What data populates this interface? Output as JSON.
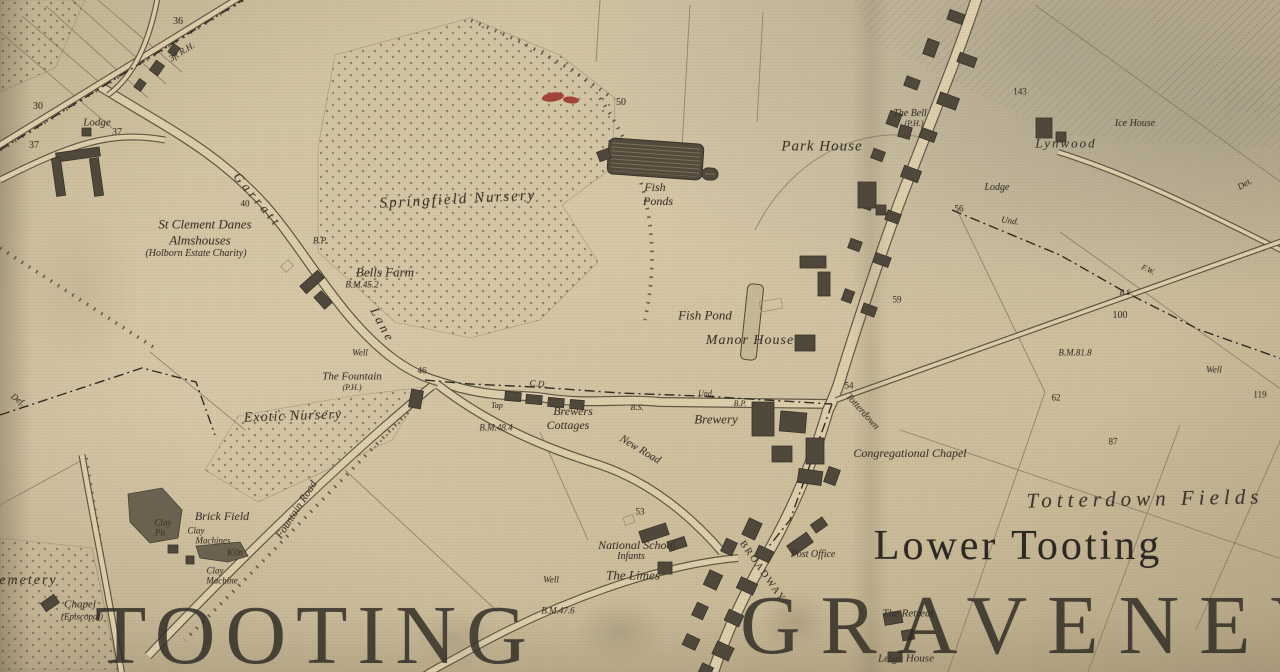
{
  "canvas": {
    "width": 1280,
    "height": 672
  },
  "palette": {
    "paper": "#d4c6a3",
    "road_fill": "#ddcfac",
    "ink": "#3a342a",
    "ink_soft": "#575040",
    "water_dark": "#51493a",
    "pit_fill": "#6a6150",
    "building_dark": "#4e473a",
    "building_light": "#9a917c",
    "red_marker": "#9b2b24",
    "big_text": "#2b2721"
  },
  "labels": [
    {
      "t": "36",
      "x": 178,
      "y": 22,
      "s": 10
    },
    {
      "t": "3ft R.H.",
      "x": 182,
      "y": 52,
      "s": 9,
      "i": 1,
      "r": -32
    },
    {
      "t": "30",
      "x": 38,
      "y": 107,
      "s": 10
    },
    {
      "t": "Lodge",
      "x": 97,
      "y": 123,
      "s": 11,
      "i": 1
    },
    {
      "t": "37",
      "x": 117,
      "y": 133,
      "s": 10
    },
    {
      "t": "37",
      "x": 34,
      "y": 146,
      "s": 10
    },
    {
      "t": "Garratt",
      "x": 258,
      "y": 200,
      "s": 13,
      "i": 1,
      "r": 50,
      "ls": 4
    },
    {
      "t": "Lane",
      "x": 383,
      "y": 325,
      "s": 13,
      "i": 1,
      "r": 62,
      "ls": 3
    },
    {
      "t": "40",
      "x": 245,
      "y": 204,
      "s": 9
    },
    {
      "t": "St Clement Danes",
      "x": 205,
      "y": 224,
      "s": 13,
      "i": 1
    },
    {
      "t": "Almshouses",
      "x": 200,
      "y": 240,
      "s": 13,
      "i": 1
    },
    {
      "t": "(Holborn Estate Charity)",
      "x": 196,
      "y": 254,
      "s": 10,
      "i": 1
    },
    {
      "t": "B.P.",
      "x": 320,
      "y": 241,
      "s": 9,
      "i": 1
    },
    {
      "t": "Springfield Nursery",
      "x": 458,
      "y": 200,
      "s": 15,
      "i": 1,
      "r": -3,
      "ls": 2
    },
    {
      "t": "Bells Farm",
      "x": 385,
      "y": 272,
      "s": 13,
      "i": 1
    },
    {
      "t": "B.M.45.2",
      "x": 362,
      "y": 285,
      "s": 9,
      "i": 1
    },
    {
      "t": "50",
      "x": 621,
      "y": 103,
      "s": 10
    },
    {
      "t": "Fish",
      "x": 655,
      "y": 187,
      "s": 12,
      "i": 1
    },
    {
      "t": "Ponds",
      "x": 658,
      "y": 201,
      "s": 12,
      "i": 1
    },
    {
      "t": "Park House",
      "x": 822,
      "y": 147,
      "s": 15,
      "i": 1,
      "ls": 1
    },
    {
      "t": "The Bell",
      "x": 910,
      "y": 114,
      "s": 10,
      "i": 1
    },
    {
      "t": "(P.H.)",
      "x": 914,
      "y": 124,
      "s": 8,
      "i": 1
    },
    {
      "t": "143",
      "x": 1020,
      "y": 92,
      "s": 9
    },
    {
      "t": "Lynwood",
      "x": 1066,
      "y": 143,
      "s": 13,
      "i": 1,
      "ls": 2
    },
    {
      "t": "Ice House",
      "x": 1135,
      "y": 124,
      "s": 10,
      "i": 1
    },
    {
      "t": "Lodge",
      "x": 997,
      "y": 188,
      "s": 10,
      "i": 1
    },
    {
      "t": "56",
      "x": 959,
      "y": 209,
      "s": 9
    },
    {
      "t": "Und.",
      "x": 1010,
      "y": 221,
      "s": 9,
      "i": 1,
      "r": 8
    },
    {
      "t": "Det.",
      "x": 1245,
      "y": 184,
      "s": 9,
      "i": 1,
      "r": -30
    },
    {
      "t": "F.W.",
      "x": 1148,
      "y": 270,
      "s": 8,
      "i": 1,
      "r": 25
    },
    {
      "t": "B.S.",
      "x": 1126,
      "y": 293,
      "s": 8,
      "i": 1
    },
    {
      "t": "100",
      "x": 1120,
      "y": 316,
      "s": 10
    },
    {
      "t": "B.M.81.8",
      "x": 1075,
      "y": 353,
      "s": 9,
      "i": 1
    },
    {
      "t": "Well",
      "x": 1214,
      "y": 370,
      "s": 9,
      "i": 1
    },
    {
      "t": "119",
      "x": 1260,
      "y": 395,
      "s": 9
    },
    {
      "t": "59",
      "x": 897,
      "y": 300,
      "s": 9
    },
    {
      "t": "62",
      "x": 1056,
      "y": 398,
      "s": 9
    },
    {
      "t": "87",
      "x": 1113,
      "y": 442,
      "s": 9
    },
    {
      "t": "Fish Pond",
      "x": 705,
      "y": 315,
      "s": 13,
      "i": 1
    },
    {
      "t": "Manor House",
      "x": 750,
      "y": 341,
      "s": 14,
      "i": 1,
      "ls": 1
    },
    {
      "t": "Brewery",
      "x": 716,
      "y": 419,
      "s": 13,
      "i": 1
    },
    {
      "t": "Und.",
      "x": 706,
      "y": 394,
      "s": 8,
      "i": 1
    },
    {
      "t": "B.P.",
      "x": 740,
      "y": 404,
      "s": 8,
      "i": 1
    },
    {
      "t": "B.S.",
      "x": 637,
      "y": 408,
      "s": 8,
      "i": 1
    },
    {
      "t": "C.D.",
      "x": 538,
      "y": 384,
      "s": 9,
      "i": 1,
      "r": 6
    },
    {
      "t": "54",
      "x": 849,
      "y": 386,
      "s": 9
    },
    {
      "t": "Totterdown",
      "x": 862,
      "y": 412,
      "s": 10,
      "i": 1,
      "r": 48
    },
    {
      "t": "Congregational Chapel",
      "x": 910,
      "y": 453,
      "s": 12,
      "i": 1
    },
    {
      "t": "Totterdown Fields",
      "x": 1145,
      "y": 499,
      "s": 21,
      "i": 1,
      "ls": 5,
      "r": -1
    },
    {
      "t": "Lower Tooting",
      "x": 1018,
      "y": 546,
      "s": 42,
      "ls": 3,
      "c": "#2b2721"
    },
    {
      "t": "The Fountain",
      "x": 352,
      "y": 377,
      "s": 11,
      "i": 1
    },
    {
      "t": "(P.H.)",
      "x": 352,
      "y": 388,
      "s": 8,
      "i": 1
    },
    {
      "t": "Well",
      "x": 360,
      "y": 353,
      "s": 9,
      "i": 1
    },
    {
      "t": "46",
      "x": 422,
      "y": 371,
      "s": 9
    },
    {
      "t": "Tap",
      "x": 497,
      "y": 406,
      "s": 8,
      "i": 1
    },
    {
      "t": "Brewers",
      "x": 573,
      "y": 411,
      "s": 12,
      "i": 1
    },
    {
      "t": "Cottages",
      "x": 568,
      "y": 425,
      "s": 12,
      "i": 1
    },
    {
      "t": "B.M.48.4",
      "x": 496,
      "y": 428,
      "s": 9,
      "i": 1
    },
    {
      "t": "New Road",
      "x": 640,
      "y": 450,
      "s": 11,
      "i": 1,
      "r": 31
    },
    {
      "t": "Exotic Nursery",
      "x": 293,
      "y": 417,
      "s": 14,
      "i": 1,
      "ls": 1,
      "r": -2
    },
    {
      "t": "Fountain Road",
      "x": 297,
      "y": 510,
      "s": 11,
      "i": 1,
      "r": -57
    },
    {
      "t": "Brick Field",
      "x": 222,
      "y": 516,
      "s": 12,
      "i": 1
    },
    {
      "t": "Clay",
      "x": 163,
      "y": 523,
      "s": 9,
      "i": 1
    },
    {
      "t": "Pit",
      "x": 160,
      "y": 533,
      "s": 9,
      "i": 1
    },
    {
      "t": "Clay",
      "x": 196,
      "y": 531,
      "s": 9,
      "i": 1
    },
    {
      "t": "Machines",
      "x": 213,
      "y": 541,
      "s": 9,
      "i": 1
    },
    {
      "t": "Kiln",
      "x": 235,
      "y": 553,
      "s": 9,
      "i": 1
    },
    {
      "t": "Clay",
      "x": 215,
      "y": 571,
      "s": 9,
      "i": 1
    },
    {
      "t": "Machine",
      "x": 222,
      "y": 581,
      "s": 9,
      "i": 1
    },
    {
      "t": "Cemetery",
      "x": -12,
      "y": 581,
      "s": 14,
      "i": 1,
      "a": "l",
      "ls": 2
    },
    {
      "t": "Chapel",
      "x": 80,
      "y": 605,
      "s": 11,
      "i": 1
    },
    {
      "t": "(Episcopal)",
      "x": 82,
      "y": 617,
      "s": 9,
      "i": 1
    },
    {
      "t": "53",
      "x": 640,
      "y": 512,
      "s": 9
    },
    {
      "t": "National School",
      "x": 637,
      "y": 545,
      "s": 12,
      "i": 1
    },
    {
      "t": "Infants",
      "x": 631,
      "y": 557,
      "s": 10,
      "i": 1
    },
    {
      "t": "The Limes",
      "x": 633,
      "y": 575,
      "s": 13,
      "i": 1
    },
    {
      "t": "Well",
      "x": 551,
      "y": 580,
      "s": 9,
      "i": 1
    },
    {
      "t": "B.M.47.6",
      "x": 558,
      "y": 611,
      "s": 9,
      "i": 1
    },
    {
      "t": "BROADWAY",
      "x": 762,
      "y": 572,
      "s": 10,
      "r": 55,
      "ls": 2
    },
    {
      "t": "Post Office",
      "x": 813,
      "y": 555,
      "s": 10,
      "i": 1
    },
    {
      "t": "The Retreat",
      "x": 908,
      "y": 614,
      "s": 11,
      "i": 1
    },
    {
      "t": "Leigh House",
      "x": 906,
      "y": 659,
      "s": 11,
      "i": 1
    },
    {
      "t": "Def.",
      "x": 18,
      "y": 400,
      "s": 9,
      "i": 1,
      "r": 35
    },
    {
      "t": "TOOTING",
      "x": 95,
      "y": 636,
      "s": 84,
      "a": "l",
      "ls": 10,
      "c": "#2b2721",
      "o": 0.82
    },
    {
      "t": "GRAVENEY",
      "x": 740,
      "y": 626,
      "s": 84,
      "a": "l",
      "ls": 20,
      "c": "#2b2721",
      "o": 0.82
    }
  ],
  "map_features": {
    "roads": [
      {
        "name": "garratt-lane",
        "w": 10,
        "d": "M 96,84 C 170,130 215,150 265,205 C 305,250 340,320 395,360 C 420,378 435,380 460,388 C 500,398 520,394 545,398 C 590,405 620,398 660,402 L 832,404"
      },
      {
        "name": "high-street",
        "w": 12,
        "d": "M 978,-6 C 960,50 935,110 912,170 C 890,225 865,300 843,370 C 838,388 833,400 828,410 C 812,465 790,515 765,558 C 745,592 725,635 712,676"
      },
      {
        "name": "new-road",
        "w": 9,
        "d": "M 438,385 C 490,425 545,448 600,465 C 650,482 690,515 722,552"
      },
      {
        "name": "fountain-road",
        "w": 9,
        "d": "M 148,656 C 230,570 330,470 432,386"
      },
      {
        "name": "north-lane",
        "w": 7,
        "d": "M -5,148 L 245,-6"
      },
      {
        "name": "lodge-lane",
        "w": 7,
        "d": "M 0,180 C 70,145 110,130 165,140"
      },
      {
        "name": "ice-house-lane",
        "w": 6,
        "d": "M 1058,152 C 1140,178 1210,215 1285,252"
      },
      {
        "name": "cemetery-lane",
        "w": 7,
        "d": "M 82,455 C 95,530 110,600 122,676"
      },
      {
        "name": "lodge-branch",
        "w": 6,
        "d": "M 158,-5 C 150,40 135,75 108,95"
      },
      {
        "name": "southwest-road",
        "w": 8,
        "d": "M 738,558 C 660,565 560,600 470,650 C 445,664 432,670 424,676"
      },
      {
        "name": "totterdown-lane",
        "w": 6,
        "d": "M 836,400 L 1285,240"
      }
    ],
    "boundaries": [
      "M 0,150 L 243,0",
      "M 0,415 L 142,368 L 196,382 L 215,435",
      "M 425,380 L 470,384 L 535,387 L 620,393 L 700,396 L 832,404",
      "M 832,404 L 790,520 L 758,560",
      "M 952,210 L 1060,255 L 1125,292 L 1200,330 L 1285,360"
    ],
    "hedges": [
      "M 0,150 L 243,0",
      "M 1060,152 C 1140,178 1210,215 1285,252",
      "M 0,248 L 158,350",
      "M 86,458 L 122,672",
      "M 600,98 C 648,170 662,240 645,320",
      "M 432,388 C 360,460 280,545 185,640",
      "M 1100,305 L 1285,242",
      "M 608,95 C 560,60 520,40 470,20"
    ],
    "field_lines": [
      "M 690,5 L 682,148",
      "M 763,12 L 757,122",
      "M 600,0 L 596,62",
      "M 755,230 C 790,160 860,120 935,140",
      "M 1035,5 L 1285,185",
      "M 958,212 L 1045,392",
      "M 1060,232 L 1285,392",
      "M 900,430 L 1285,560",
      "M 1045,392 L 948,672",
      "M 1180,425 L 1088,672",
      "M 1285,430 L 1196,630",
      "M 345,470 L 498,612",
      "M 540,432 L 588,540",
      "M 0,505 L 86,458",
      "M 0,32 L 112,128",
      "M 22,16 L 134,112",
      "M 46,6 L 148,98",
      "M 72,0 L 166,84",
      "M 98,0 L 182,72",
      "M 150,352 L 245,430",
      "M 836,400 L 1285,240"
    ],
    "urban_hatch": [
      "855,0 1285,0 1285,150 1060,135 940,75 870,40",
      "1150,0 1285,0 1285,120 1160,95"
    ],
    "orchards": [
      "335,55 470,18 560,55 615,98 612,168 562,205 598,262 540,320 470,338 395,322 318,252 318,148",
      "0,0 85,0 55,68 0,92",
      "205,470 238,416 352,396 425,387 392,440 258,502",
      "0,538 92,548 118,670 0,670"
    ],
    "ponds_dark": [
      {
        "name": "fish-ponds",
        "x": 608,
        "y": 141,
        "w": 95,
        "h": 36,
        "r": 4
      },
      {
        "name": "fish-ponds-small",
        "x": 702,
        "y": 168,
        "w": 16,
        "h": 12,
        "r": 4
      }
    ],
    "ponds_light": [
      {
        "name": "manor-fish-pond",
        "x": 744,
        "y": 284,
        "w": 16,
        "h": 76,
        "r": 6
      }
    ],
    "pits": [
      "128,494 162,488 182,510 178,538 150,543 130,522",
      "196,546 240,542 248,556 228,562 200,558"
    ],
    "buildings": [
      [
        948,
        12,
        16,
        10,
        20,
        "d"
      ],
      [
        925,
        40,
        12,
        16,
        20,
        "d"
      ],
      [
        958,
        55,
        18,
        10,
        20,
        "d"
      ],
      [
        905,
        78,
        14,
        10,
        20,
        "d"
      ],
      [
        938,
        95,
        20,
        12,
        20,
        "d"
      ],
      [
        888,
        112,
        12,
        14,
        20,
        "d"
      ],
      [
        920,
        130,
        16,
        10,
        20,
        "d"
      ],
      [
        872,
        150,
        12,
        10,
        20,
        "d"
      ],
      [
        902,
        168,
        18,
        12,
        20,
        "d"
      ],
      [
        861,
        195,
        12,
        14,
        20,
        "d"
      ],
      [
        886,
        212,
        14,
        10,
        20,
        "d"
      ],
      [
        849,
        240,
        12,
        10,
        20,
        "d"
      ],
      [
        874,
        255,
        16,
        10,
        20,
        "d"
      ],
      [
        843,
        290,
        10,
        12,
        20,
        "d"
      ],
      [
        862,
        305,
        14,
        10,
        20,
        "d"
      ],
      [
        752,
        402,
        22,
        34,
        0,
        "d"
      ],
      [
        780,
        412,
        26,
        20,
        5,
        "d"
      ],
      [
        806,
        438,
        18,
        26,
        0,
        "d"
      ],
      [
        772,
        446,
        20,
        16,
        0,
        "d"
      ],
      [
        798,
        470,
        24,
        14,
        8,
        "d"
      ],
      [
        800,
        256,
        26,
        12,
        0,
        "d"
      ],
      [
        818,
        272,
        12,
        24,
        0,
        "d"
      ],
      [
        795,
        335,
        20,
        16,
        0,
        "d"
      ],
      [
        760,
        300,
        22,
        10,
        -10,
        "l"
      ],
      [
        858,
        182,
        18,
        26,
        0,
        "d"
      ],
      [
        876,
        205,
        10,
        10,
        0,
        "d"
      ],
      [
        899,
        126,
        12,
        12,
        15,
        "d"
      ],
      [
        1036,
        118,
        16,
        20,
        0,
        "d"
      ],
      [
        1056,
        132,
        10,
        10,
        0,
        "d"
      ],
      [
        598,
        150,
        12,
        10,
        -20,
        "d"
      ],
      [
        300,
        277,
        24,
        10,
        -42,
        "d"
      ],
      [
        318,
        292,
        10,
        16,
        -42,
        "d"
      ],
      [
        282,
        262,
        10,
        8,
        -42,
        "l"
      ],
      [
        56,
        150,
        44,
        9,
        -8,
        "d"
      ],
      [
        54,
        158,
        9,
        38,
        -8,
        "d"
      ],
      [
        92,
        158,
        9,
        38,
        -8,
        "d"
      ],
      [
        82,
        128,
        9,
        8,
        0,
        "d"
      ],
      [
        152,
        62,
        10,
        12,
        35,
        "d"
      ],
      [
        170,
        45,
        8,
        10,
        35,
        "d"
      ],
      [
        136,
        80,
        8,
        10,
        35,
        "d"
      ],
      [
        410,
        390,
        12,
        18,
        10,
        "d"
      ],
      [
        505,
        392,
        16,
        9,
        5,
        "d"
      ],
      [
        526,
        395,
        16,
        9,
        5,
        "d"
      ],
      [
        548,
        398,
        16,
        9,
        5,
        "d"
      ],
      [
        570,
        400,
        14,
        9,
        5,
        "d"
      ],
      [
        640,
        527,
        28,
        12,
        -18,
        "d"
      ],
      [
        668,
        539,
        18,
        10,
        -18,
        "d"
      ],
      [
        624,
        516,
        10,
        8,
        -18,
        "l"
      ],
      [
        658,
        562,
        14,
        12,
        0,
        "d"
      ],
      [
        745,
        520,
        14,
        18,
        25,
        "d"
      ],
      [
        723,
        540,
        12,
        14,
        25,
        "d"
      ],
      [
        756,
        548,
        16,
        12,
        25,
        "d"
      ],
      [
        706,
        572,
        14,
        16,
        25,
        "d"
      ],
      [
        738,
        580,
        18,
        12,
        25,
        "d"
      ],
      [
        694,
        604,
        12,
        14,
        25,
        "d"
      ],
      [
        726,
        612,
        16,
        12,
        25,
        "d"
      ],
      [
        684,
        636,
        14,
        12,
        25,
        "d"
      ],
      [
        714,
        644,
        18,
        14,
        25,
        "d"
      ],
      [
        700,
        665,
        12,
        10,
        25,
        "d"
      ],
      [
        788,
        538,
        24,
        12,
        -35,
        "d"
      ],
      [
        812,
        520,
        14,
        10,
        -35,
        "d"
      ],
      [
        826,
        468,
        12,
        16,
        20,
        "d"
      ],
      [
        884,
        612,
        18,
        12,
        -10,
        "d"
      ],
      [
        902,
        630,
        12,
        10,
        -10,
        "d"
      ],
      [
        888,
        652,
        14,
        10,
        0,
        "d"
      ],
      [
        42,
        598,
        16,
        10,
        -35,
        "d"
      ],
      [
        168,
        545,
        10,
        8,
        0,
        "d"
      ],
      [
        186,
        556,
        8,
        8,
        0,
        "d"
      ]
    ],
    "red_marker": {
      "ellipses": [
        [
          553,
          97,
          22,
          9,
          -8
        ],
        [
          571,
          100,
          16,
          7,
          5
        ]
      ]
    }
  }
}
